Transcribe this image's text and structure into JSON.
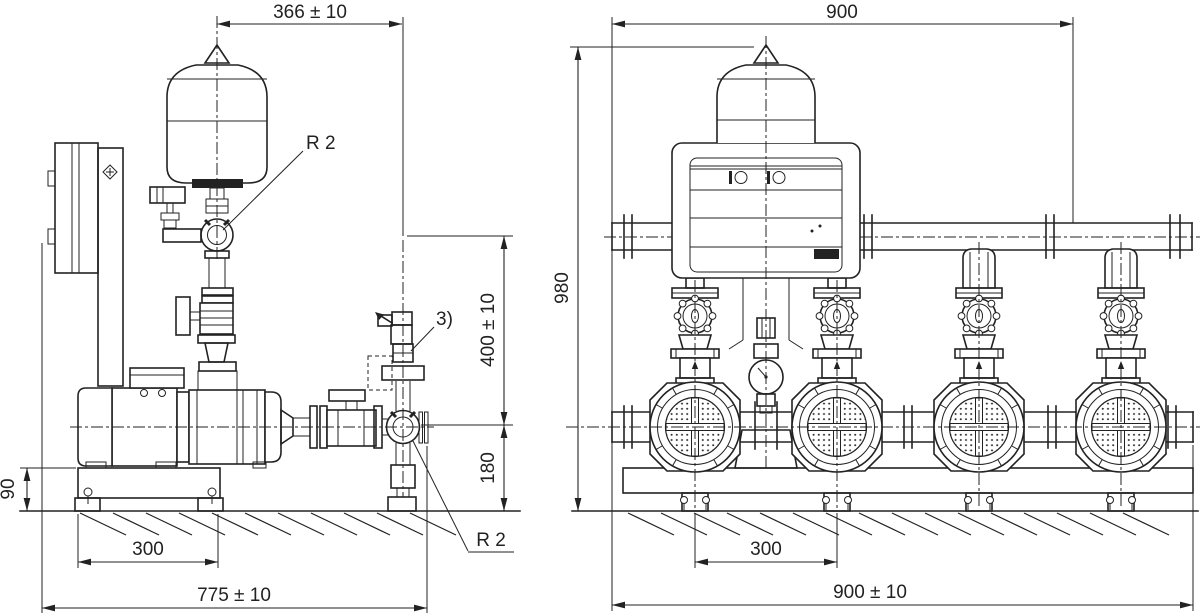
{
  "drawing": {
    "type": "technical-dimension-drawing",
    "subject": "pressure boosting system, two projection views",
    "background": "#ffffff",
    "line_color": "#222222",
    "side_view": {
      "dims": {
        "top_width": "366 ± 10",
        "tank_connection": "R 2",
        "note_ref": "3)",
        "height_upper": "400 ± 10",
        "height_lower": "180",
        "base_height": "90",
        "anchor_spacing": "300",
        "overall_length": "775 ± 10",
        "outlet_connection": "R 2"
      }
    },
    "front_view": {
      "dims": {
        "manifold_length": "900",
        "overall_height": "980",
        "pump_spacing": "300",
        "base_length": "900 ± 10"
      }
    }
  }
}
